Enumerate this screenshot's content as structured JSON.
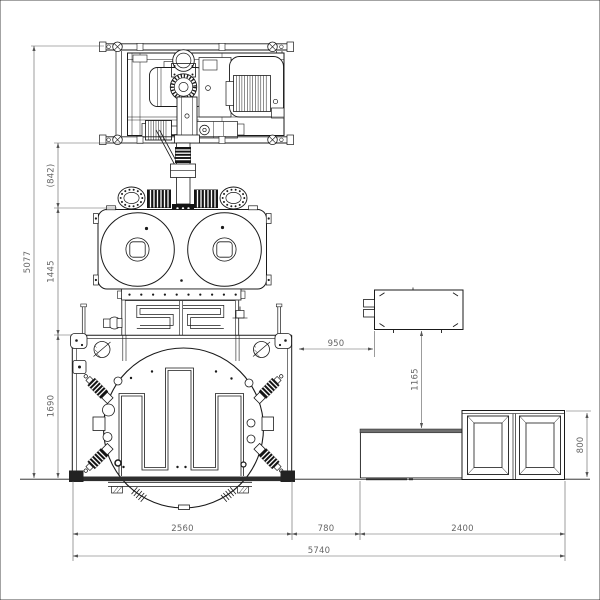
{
  "drawing": {
    "colors": {
      "ink": "#1a1a1a",
      "dim_line": "#5a5a5a",
      "dim_text": "#666666",
      "background": "#ffffff"
    },
    "dims": {
      "overall_height": "5077",
      "arm_gap": "(842)",
      "drum_to_table": "1445",
      "table_height": "1690",
      "table_to_box": "950",
      "box_to_bench": "1165",
      "cabinet_height": "800",
      "table_width": "2560",
      "gap_width": "780",
      "bench_width": "2400",
      "overall_width": "5740"
    }
  }
}
